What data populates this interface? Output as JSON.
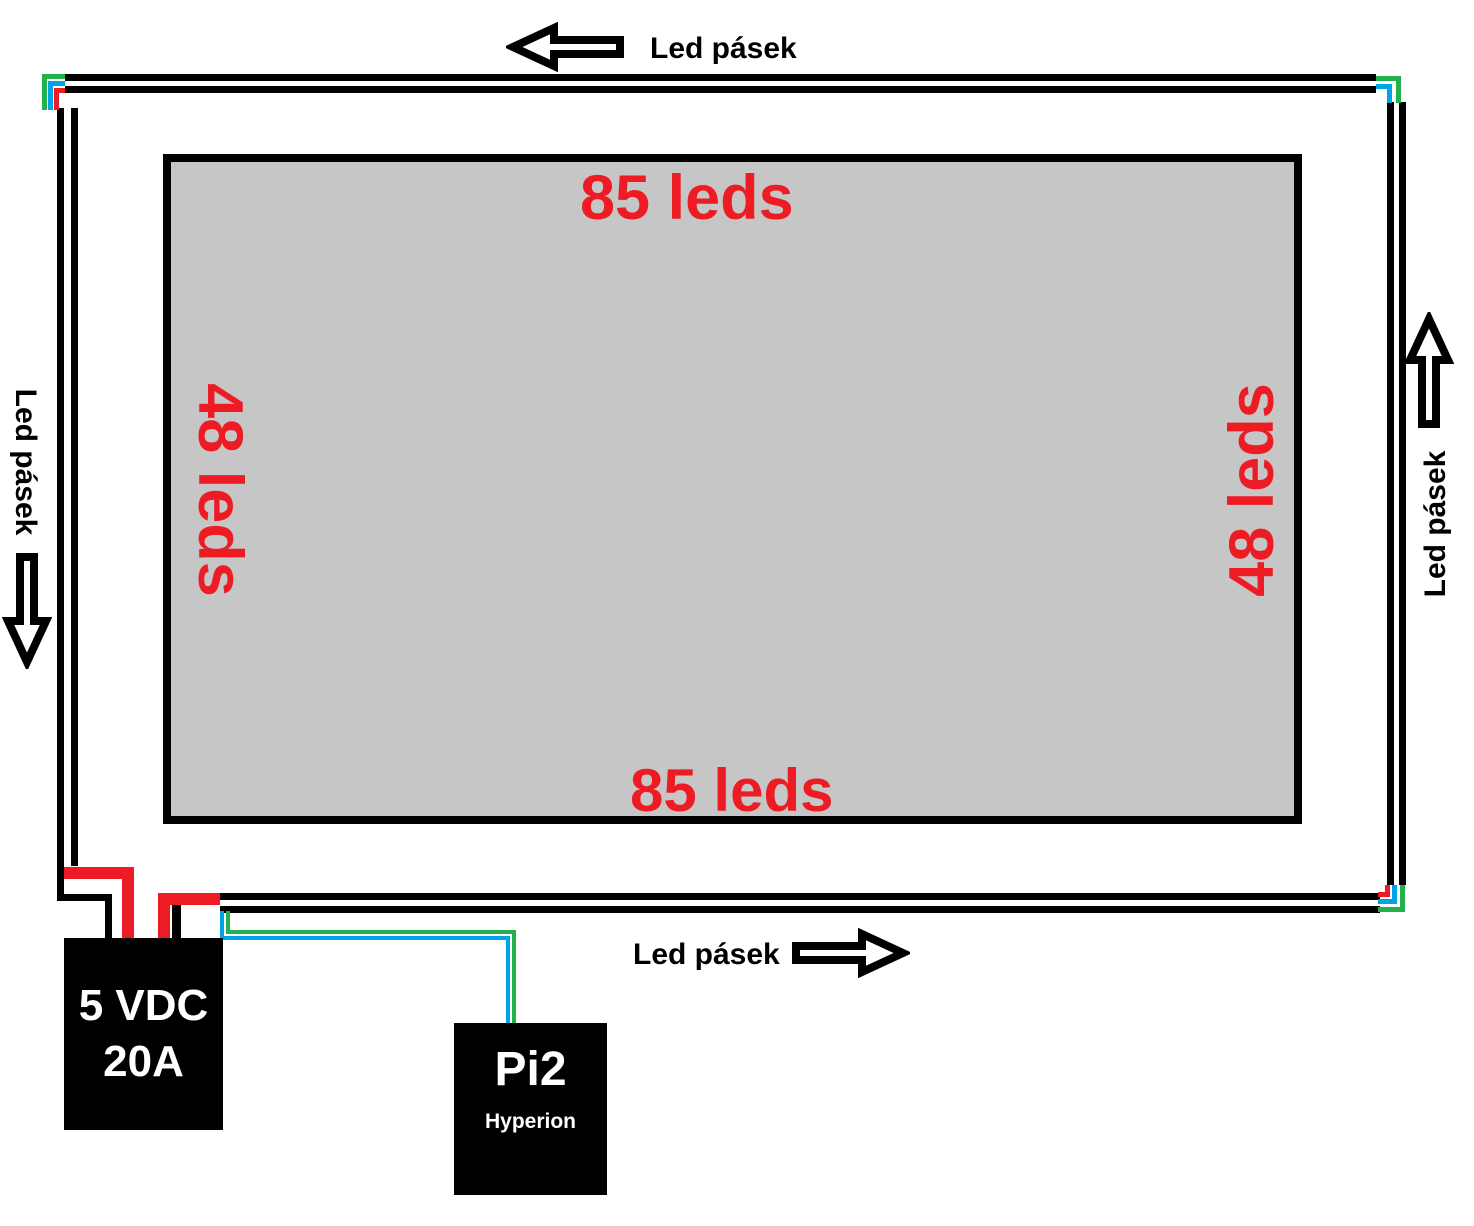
{
  "strip_labels": {
    "top": "Led pásek",
    "bottom": "Led pásek",
    "left": "Led pásek",
    "right": "Led pásek"
  },
  "led_counts": {
    "top": "85 leds",
    "bottom": "85 leds",
    "left": "48 leds",
    "right": "48 leds"
  },
  "power_supply": {
    "voltage": "5 VDC",
    "current": "20A"
  },
  "controller": {
    "name": "Pi2",
    "software": "Hyperion"
  },
  "colors": {
    "wire_red": "#ed1c24",
    "wire_green": "#22b14c",
    "wire_blue": "#00a2e8",
    "strip_black": "#000000",
    "screen_fill": "#c6c6c6",
    "count_text": "#ed1c24"
  }
}
